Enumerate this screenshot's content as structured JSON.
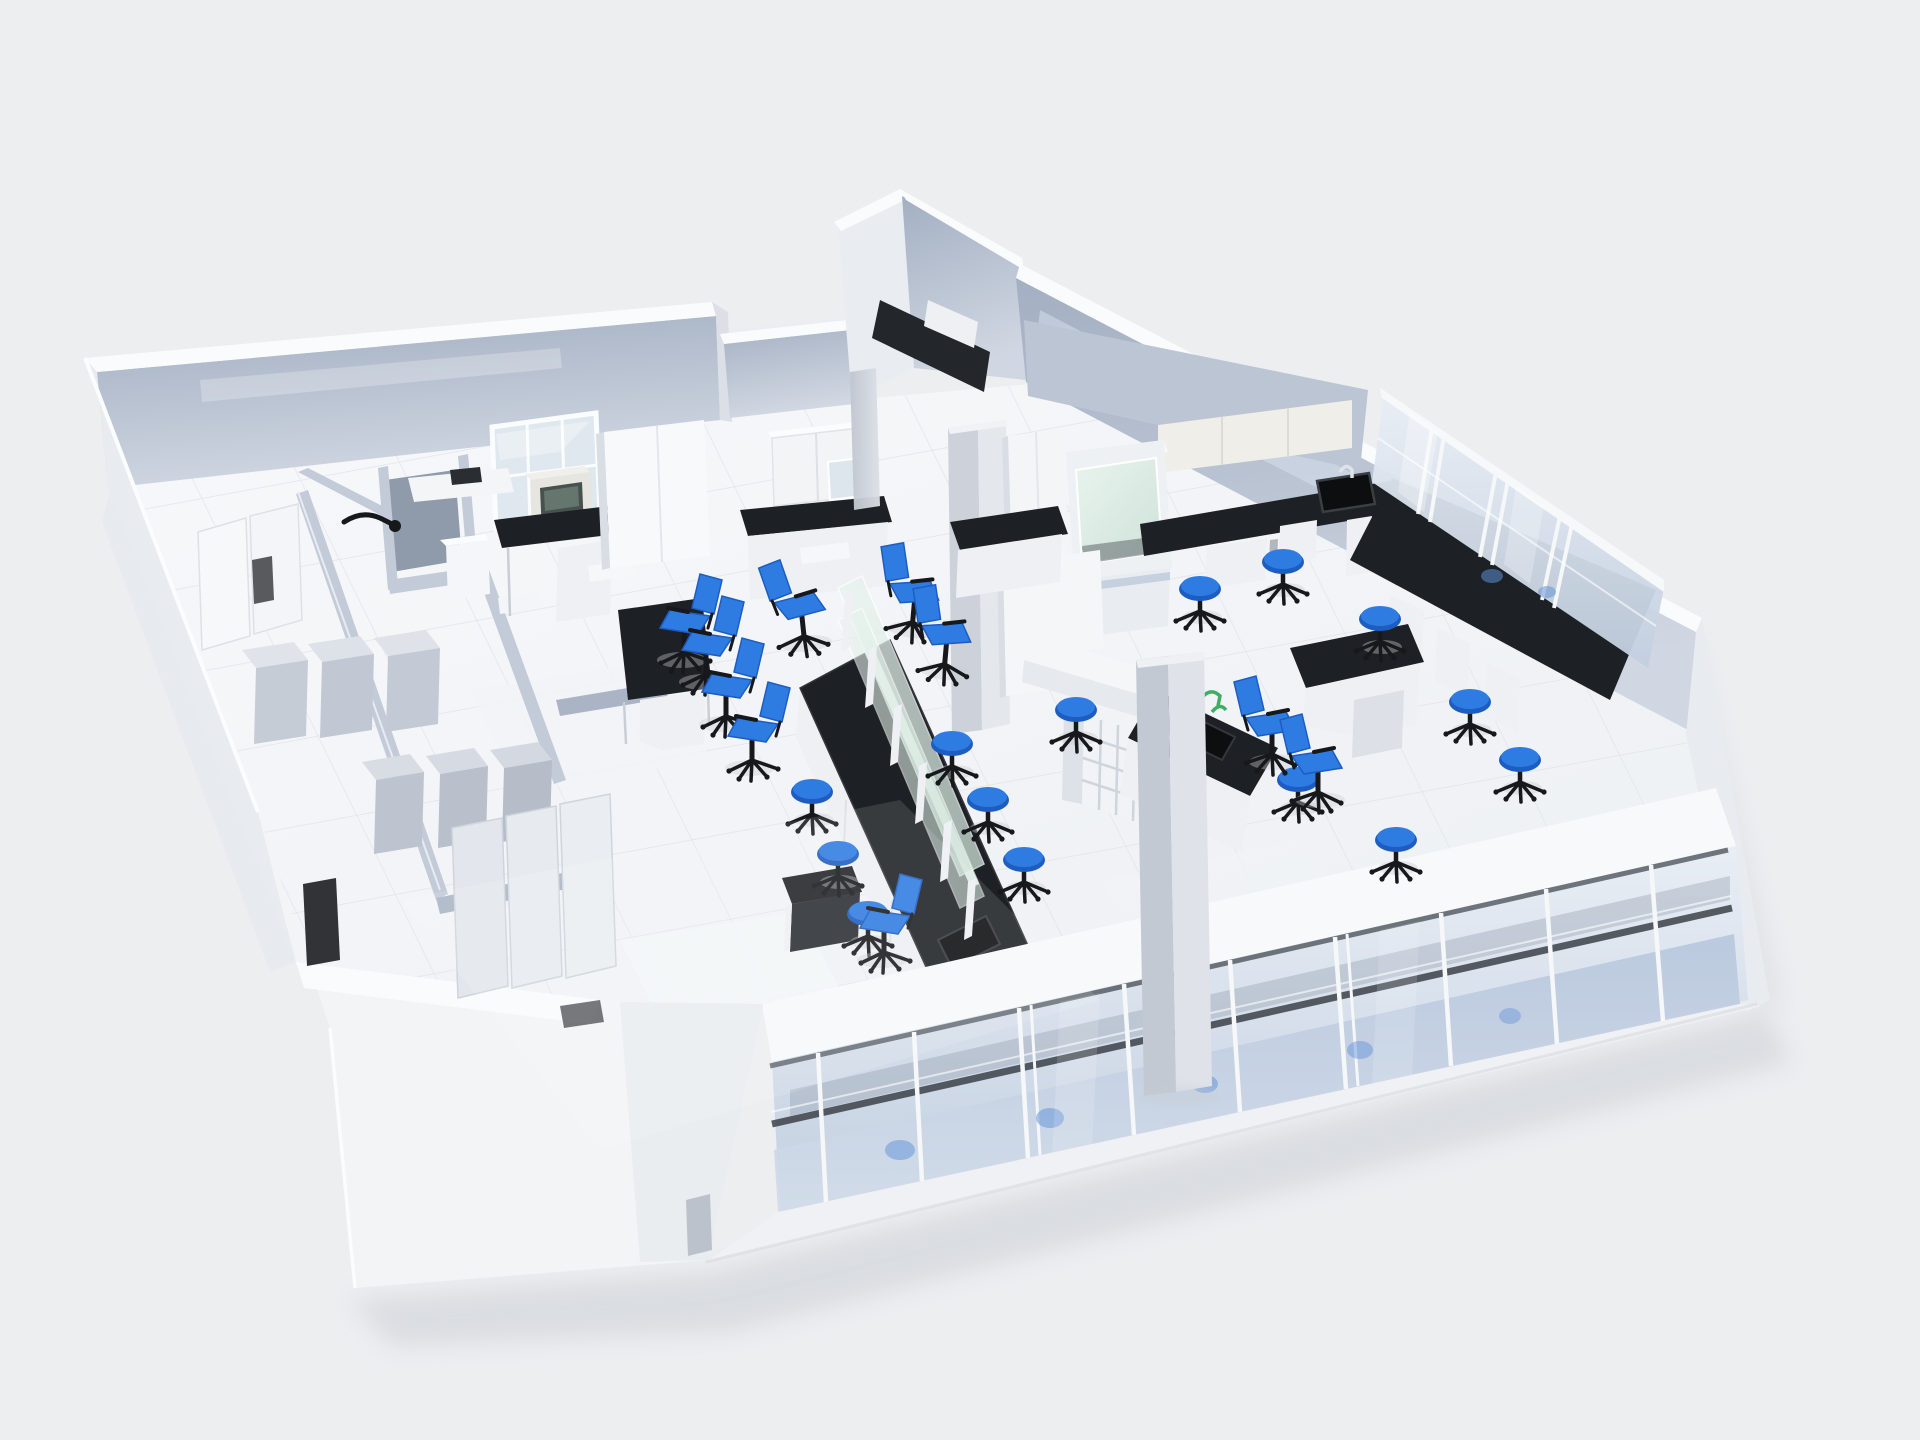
{
  "meta": {
    "domain": "Diagram",
    "title": "Laboratory 3D floor plan",
    "description": "Isometric cutaway 3D rendering of a laboratory interior with lab benches, blue stools and task chairs, fume hood, glass storage cabinets and a glass curtain wall facade",
    "render_style": "architectural visualization, no on-screen text"
  },
  "palette": {
    "bg": "#edeef0",
    "wall_top": "#fafbfd",
    "wall_face": "#e8ebef",
    "wall_face_dark": "#dce0e6",
    "wall_inner_a": "#a3afc2",
    "wall_inner_b": "#d0d7e2",
    "partition": "#c3cbd8",
    "partition_dark": "#aab4c5",
    "floor_a": "#f7f8fa",
    "floor_b": "#edf0f4",
    "tile_line": "#e2e6ec",
    "bench_top": "#1d2024",
    "bench_top_edge": "#34383e",
    "bench_base": "#eef0f3",
    "bench_base_shade": "#dde1e7",
    "glass_a": "#e9eef5",
    "glass_b": "#c2cfe0",
    "spandrel_a": "#b8c7dd",
    "spandrel_b": "#d3ddea",
    "mullion": "#f5f7f9",
    "transom_dark": "#3c4148",
    "green_glass_a": "#e9f4ee",
    "green_glass_b": "#cde2d8",
    "accent_blue": "#2e7ce2",
    "accent_blue_dark": "#1d5cc0",
    "frame_black": "#17181b",
    "column_a": "#dde1e7",
    "column_b": "#bfc5cf",
    "cream_cabinet": "#efeee8",
    "shadow": "#c7ccd3",
    "faucet_green": "#3fae62"
  },
  "scene": {
    "rooms": [
      {
        "name": "instrument-room",
        "position": "top-left"
      },
      {
        "name": "storage-rooms",
        "position": "lower-left"
      },
      {
        "name": "main-lab",
        "position": "center"
      },
      {
        "name": "analysis-lab",
        "position": "top-right"
      },
      {
        "name": "entry-alcove",
        "position": "top-center"
      }
    ],
    "furniture_inventory": {
      "island_benches": 1,
      "wall_benches": 4,
      "desks": 3,
      "tables": 1,
      "blue_stools": 14,
      "blue_task_chairs": 10,
      "fume_hoods": 1,
      "bench_instruments": 1,
      "glass_cabinet_doors": 6,
      "wall_cabinet_runs": 3,
      "tall_cabinets": 4,
      "storage_cabinets": 9,
      "open_shelf_cubbies": 1,
      "sinks": 3,
      "structural_columns": 2,
      "doors": 2
    },
    "glazing": {
      "curtain_wall_mullions": 9,
      "curtain_wall_transoms": 1,
      "window_panes": 6,
      "reagent_shelf_levels": 2
    }
  }
}
